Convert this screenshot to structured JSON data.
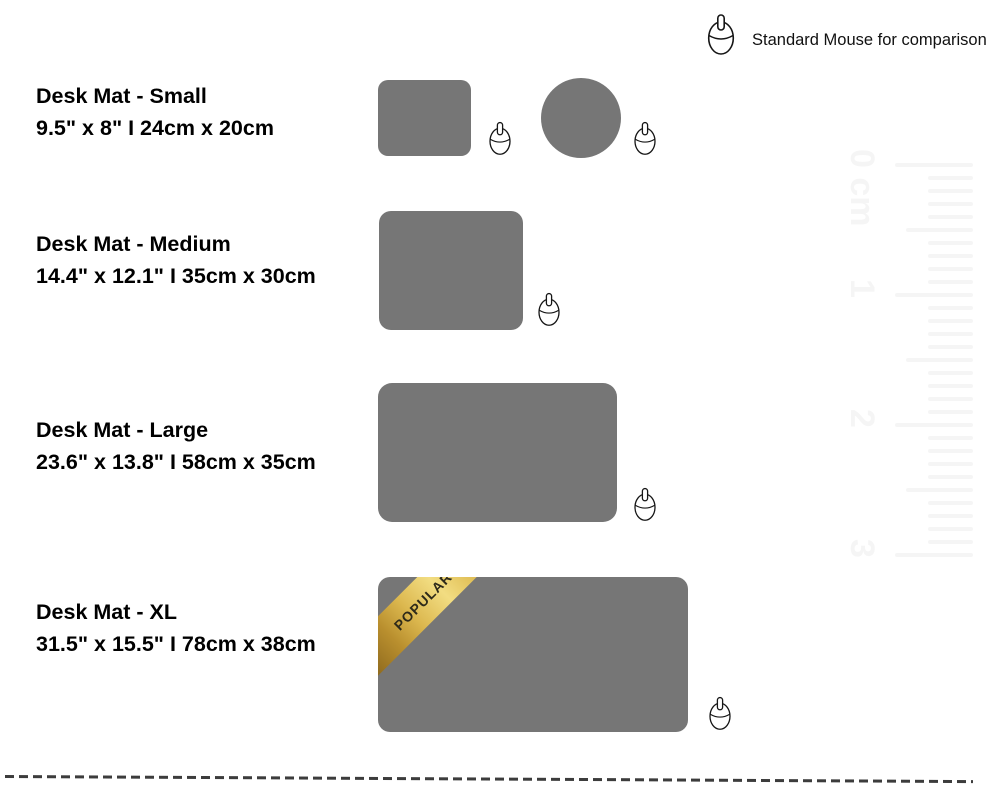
{
  "header": {
    "comparison_label": "Standard Mouse for comparison"
  },
  "products": [
    {
      "id": "small",
      "name": "Desk Mat - Small",
      "dimensions": "9.5\" x 8\" I 24cm x 20cm"
    },
    {
      "id": "medium",
      "name": "Desk Mat - Medium",
      "dimensions": "14.4\" x 12.1\" I 35cm x 30cm"
    },
    {
      "id": "large",
      "name": "Desk Mat - Large",
      "dimensions": "23.6\" x 13.8\" I 58cm x 35cm"
    },
    {
      "id": "xl",
      "name": "Desk Mat - XL",
      "dimensions": "31.5\" x 15.5\" I 78cm x 38cm",
      "badge": "POPULAR"
    }
  ],
  "ruler": {
    "marks": [
      {
        "label": "0 cm",
        "y": 165
      },
      {
        "label": "1",
        "y": 295
      },
      {
        "label": "2",
        "y": 425
      },
      {
        "label": "3",
        "y": 555
      }
    ]
  },
  "colors": {
    "mat": "#767676",
    "ruler": "#f5f5f5",
    "dash": "#3c3c3c",
    "ribbon_text": "#2e2a1a"
  }
}
